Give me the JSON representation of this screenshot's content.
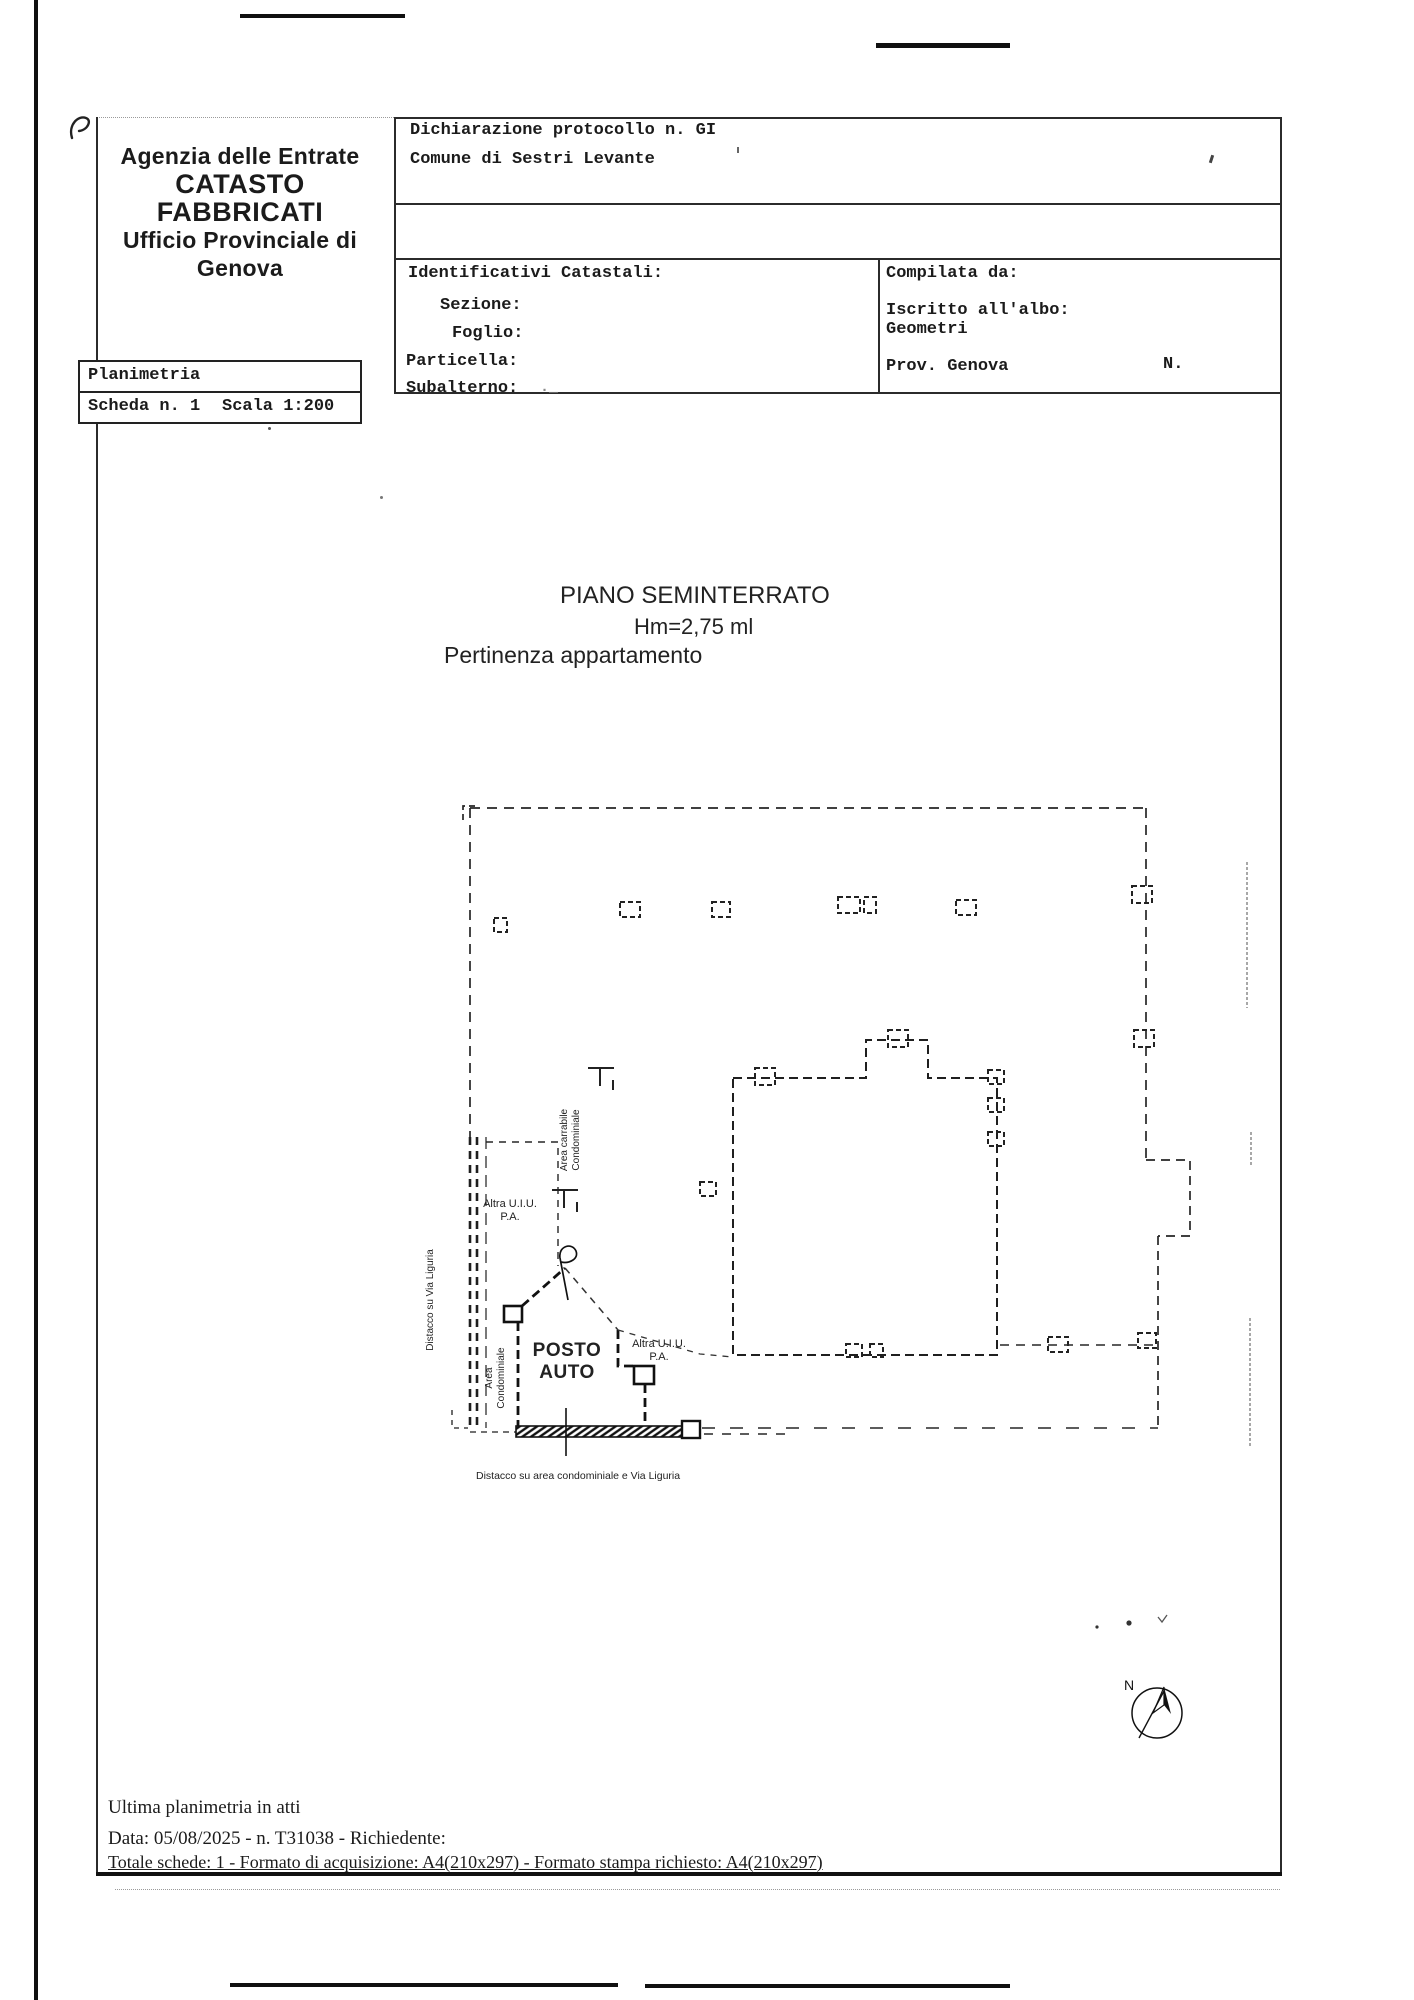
{
  "header": {
    "agency": {
      "line1": "Agenzia delle Entrate",
      "line2": "CATASTO FABBRICATI",
      "line3": "Ufficio Provinciale di",
      "line4": "Genova"
    },
    "protocol_line1": "Dichiarazione protocollo n. GI",
    "protocol_line2": "Comune di Sestri Levante",
    "catastali": {
      "title": "Identificativi Catastali:",
      "sezione_label": "Sezione:",
      "foglio_label": "Foglio:",
      "particella_label": "Particella:",
      "subalterno_label": "Subalterno:",
      "subalterno_value": "._"
    },
    "compilata": {
      "title": "Compilata da:",
      "albo_line1": "Iscritto all'albo:",
      "albo_line2": "Geometri",
      "prov": "Prov. Genova",
      "n_label": "N."
    },
    "planimetria": "Planimetria",
    "scheda": "Scheda n. 1",
    "scala": "Scala 1:200"
  },
  "plan": {
    "floor_title": "PIANO SEMINTERRATO",
    "height_label": "Hm=2,75 ml",
    "pertinenza_label": "Pertinenza appartamento",
    "labels": {
      "altra_uiu_top_1": "Altra U.I.U.",
      "altra_uiu_top_2": "P.A.",
      "area_carrabile_1": "Area carrabile",
      "area_carrabile_2": "Condominiale",
      "distacco_via": "Distacco su Via Liguria",
      "area_cond_1": "Area",
      "area_cond_2": "Condominiale",
      "posto_auto_1": "POSTO",
      "posto_auto_2": "AUTO",
      "altra_uiu_bottom_1": "Altra U.I.U.",
      "altra_uiu_bottom_2": "P.A.",
      "distacco_bottom": "Distacco su area condominiale e Via Liguria"
    },
    "compass": "N"
  },
  "footer": {
    "line1": "Ultima planimetria in atti",
    "line2": "Data: 05/08/2025 - n. T31038 - Richiedente:",
    "line3": "Totale schede: 1 - Formato di acquisizione: A4(210x297)  - Formato stampa richiesto: A4(210x297)"
  }
}
